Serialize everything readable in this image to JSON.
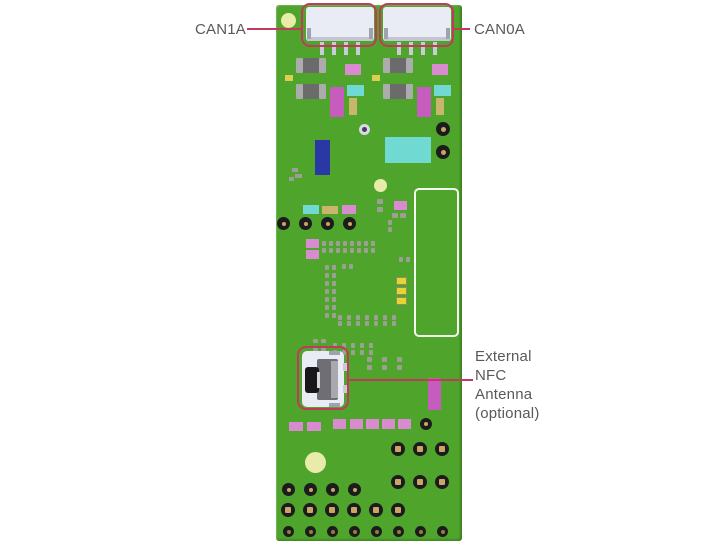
{
  "annotations": {
    "can1a": {
      "text": "CAN1A"
    },
    "can0a": {
      "text": "CAN0A"
    },
    "nfc": {
      "text": "External\nNFC\nAntenna\n(optional)"
    }
  },
  "colors": {
    "green": "#4FA52C",
    "red": "#C23A5B",
    "labelText": "#58595B",
    "connWhite": "#E9EBF5",
    "connShade": "#C3C6D2",
    "pinGray": "#C9CCD6",
    "tabGray": "#9FA3B0",
    "capGray": "#ACACAC",
    "chipDark": "#6B6B6B",
    "orchid": "#D98BD0",
    "magenta": "#C55CBE",
    "cyan": "#6FD9D2",
    "khaki": "#C9B56B",
    "blue": "#2A38A5",
    "paleYellow": "#E9EBA9",
    "padGray": "#9C9F94",
    "yellowPad": "#E6D435",
    "padBorder": "#8F8F5D",
    "holeBlack": "#1C1C1C",
    "holeTan": "#C9A567",
    "holeOlive": "#8F7F40",
    "white": "#F4F7F0",
    "viaWhite": "#DADAE4",
    "viaDot": "#4A3B63",
    "socketDark": "#6E6E74",
    "socketLight": "#A8A8B0",
    "socketBlack": "#17171B",
    "slitWhite": "#D8D8DC",
    "yellowDot": "#DCCE4E"
  },
  "board": {
    "x": 276,
    "y": 5,
    "w": 186,
    "h": 536,
    "items": [
      {
        "t": "c",
        "x": 281,
        "y": 13,
        "d": 15,
        "c": "paleYellow",
        "n": "fiducial-dot"
      },
      {
        "t": "c",
        "x": 374,
        "y": 179,
        "d": 13,
        "c": "paleYellow",
        "n": "fiducial-dot"
      },
      {
        "t": "c",
        "x": 305,
        "y": 452,
        "d": 21,
        "c": "paleYellow",
        "n": "fiducial-dot"
      },
      {
        "t": "r",
        "x": 306,
        "y": 7,
        "w": 68,
        "h": 34,
        "c": "connWhite",
        "r": 3,
        "n": "can1a-connector"
      },
      {
        "t": "r",
        "x": 307,
        "y": 37,
        "w": 66,
        "h": 4,
        "c": "connShade",
        "n": "connector-shadow"
      },
      {
        "t": "r",
        "x": 307,
        "y": 28,
        "w": 4,
        "h": 11,
        "c": "tabGray",
        "n": "connector-tab"
      },
      {
        "t": "r",
        "x": 369,
        "y": 28,
        "w": 4,
        "h": 11,
        "c": "tabGray",
        "n": "connector-tab"
      },
      {
        "t": "r",
        "x": 320,
        "y": 42,
        "w": 4,
        "h": 13,
        "c": "pinGray",
        "n": "connector-pin"
      },
      {
        "t": "r",
        "x": 332,
        "y": 42,
        "w": 4,
        "h": 13,
        "c": "pinGray",
        "n": "connector-pin"
      },
      {
        "t": "r",
        "x": 344,
        "y": 42,
        "w": 4,
        "h": 13,
        "c": "pinGray",
        "n": "connector-pin"
      },
      {
        "t": "r",
        "x": 356,
        "y": 42,
        "w": 4,
        "h": 13,
        "c": "pinGray",
        "n": "connector-pin"
      },
      {
        "t": "r",
        "x": 383,
        "y": 7,
        "w": 68,
        "h": 34,
        "c": "connWhite",
        "r": 3,
        "n": "can0a-connector"
      },
      {
        "t": "r",
        "x": 384,
        "y": 37,
        "w": 66,
        "h": 4,
        "c": "connShade",
        "n": "connector-shadow"
      },
      {
        "t": "r",
        "x": 384,
        "y": 28,
        "w": 4,
        "h": 11,
        "c": "tabGray",
        "n": "connector-tab"
      },
      {
        "t": "r",
        "x": 446,
        "y": 28,
        "w": 4,
        "h": 11,
        "c": "tabGray",
        "n": "connector-tab"
      },
      {
        "t": "r",
        "x": 397,
        "y": 42,
        "w": 4,
        "h": 13,
        "c": "pinGray",
        "n": "connector-pin"
      },
      {
        "t": "r",
        "x": 409,
        "y": 42,
        "w": 4,
        "h": 13,
        "c": "pinGray",
        "n": "connector-pin"
      },
      {
        "t": "r",
        "x": 421,
        "y": 42,
        "w": 4,
        "h": 13,
        "c": "pinGray",
        "n": "connector-pin"
      },
      {
        "t": "r",
        "x": 433,
        "y": 42,
        "w": 4,
        "h": 13,
        "c": "pinGray",
        "n": "connector-pin"
      },
      {
        "t": "chip",
        "x": 296,
        "y": 58,
        "w": 30,
        "h": 15,
        "n": "smd-chip"
      },
      {
        "t": "chip",
        "x": 296,
        "y": 84,
        "w": 30,
        "h": 15,
        "n": "smd-chip"
      },
      {
        "t": "r",
        "x": 285,
        "y": 75,
        "w": 8,
        "h": 6,
        "c": "yellowDot",
        "n": "smd-pad"
      },
      {
        "t": "r",
        "x": 345,
        "y": 64,
        "w": 16,
        "h": 11,
        "c": "orchid",
        "n": "smd-component"
      },
      {
        "t": "r",
        "x": 330,
        "y": 87,
        "w": 14,
        "h": 30,
        "c": "magenta",
        "n": "smd-component"
      },
      {
        "t": "r",
        "x": 347,
        "y": 85,
        "w": 17,
        "h": 11,
        "c": "cyan",
        "n": "smd-component"
      },
      {
        "t": "r",
        "x": 349,
        "y": 98,
        "w": 8,
        "h": 17,
        "c": "khaki",
        "n": "smd-component"
      },
      {
        "t": "chip",
        "x": 383,
        "y": 58,
        "w": 30,
        "h": 15,
        "n": "smd-chip"
      },
      {
        "t": "chip",
        "x": 383,
        "y": 84,
        "w": 30,
        "h": 15,
        "n": "smd-chip"
      },
      {
        "t": "r",
        "x": 372,
        "y": 75,
        "w": 8,
        "h": 6,
        "c": "yellowDot",
        "n": "smd-pad"
      },
      {
        "t": "r",
        "x": 432,
        "y": 64,
        "w": 16,
        "h": 11,
        "c": "orchid",
        "n": "smd-component"
      },
      {
        "t": "r",
        "x": 417,
        "y": 87,
        "w": 14,
        "h": 30,
        "c": "magenta",
        "n": "smd-component"
      },
      {
        "t": "r",
        "x": 434,
        "y": 85,
        "w": 17,
        "h": 11,
        "c": "cyan",
        "n": "smd-component"
      },
      {
        "t": "r",
        "x": 436,
        "y": 98,
        "w": 8,
        "h": 17,
        "c": "khaki",
        "n": "smd-component"
      },
      {
        "t": "c",
        "x": 359,
        "y": 124,
        "d": 11,
        "c": "viaWhite",
        "n": "test-point"
      },
      {
        "t": "c",
        "x": 362,
        "y": 127,
        "d": 5,
        "c": "viaDot",
        "n": "test-point-center"
      },
      {
        "t": "r",
        "x": 315,
        "y": 140,
        "w": 15,
        "h": 35,
        "c": "blue",
        "n": "smd-component"
      },
      {
        "t": "r",
        "x": 385,
        "y": 137,
        "w": 46,
        "h": 26,
        "c": "cyan",
        "n": "smd-component"
      },
      {
        "t": "h",
        "x": 436,
        "y": 122,
        "d": 14,
        "cd": 5,
        "n": "via-hole"
      },
      {
        "t": "h",
        "x": 436,
        "y": 145,
        "d": 14,
        "cd": 5,
        "n": "via-hole"
      },
      {
        "t": "r",
        "x": 292,
        "y": 168,
        "w": 6,
        "h": 4,
        "c": "padGray",
        "n": "smd-pad"
      },
      {
        "t": "r",
        "x": 295,
        "y": 174,
        "w": 7,
        "h": 4,
        "c": "padGray",
        "n": "smd-pad"
      },
      {
        "t": "r",
        "x": 289,
        "y": 177,
        "w": 5,
        "h": 4,
        "c": "padGray",
        "n": "smd-pad"
      },
      {
        "t": "o",
        "x": 414,
        "y": 188,
        "w": 45,
        "h": 149,
        "r": 5,
        "bc": "white",
        "bw": 2,
        "n": "module-outline"
      },
      {
        "t": "r",
        "x": 303,
        "y": 205,
        "w": 16,
        "h": 9,
        "c": "cyan",
        "n": "smd-component"
      },
      {
        "t": "r",
        "x": 322,
        "y": 206,
        "w": 16,
        "h": 8,
        "c": "khaki",
        "n": "smd-component"
      },
      {
        "t": "r",
        "x": 342,
        "y": 205,
        "w": 14,
        "h": 9,
        "c": "orchid",
        "n": "smd-component"
      },
      {
        "t": "grid",
        "x": 377,
        "y": 199,
        "cols": 1,
        "rows": 2,
        "dx": 0,
        "dy": 8,
        "w": 6,
        "h": 5,
        "c": "padGray",
        "n": "pad-array"
      },
      {
        "t": "r",
        "x": 394,
        "y": 201,
        "w": 13,
        "h": 9,
        "c": "orchid",
        "n": "smd-component"
      },
      {
        "t": "grid",
        "x": 392,
        "y": 213,
        "cols": 2,
        "rows": 1,
        "dx": 8,
        "dy": 0,
        "w": 6,
        "h": 5,
        "c": "padGray",
        "n": "pad-array"
      },
      {
        "t": "hrow",
        "x": 277,
        "y": 217,
        "n2": 4,
        "dx": 22,
        "d": 13,
        "cd": 4,
        "n": "via-hole-row"
      },
      {
        "t": "r",
        "x": 306,
        "y": 239,
        "w": 13,
        "h": 9,
        "c": "orchid",
        "n": "smd-component"
      },
      {
        "t": "r",
        "x": 306,
        "y": 250,
        "w": 13,
        "h": 9,
        "c": "orchid",
        "n": "smd-component"
      },
      {
        "t": "grid",
        "x": 322,
        "y": 241,
        "cols": 8,
        "rows": 2,
        "dx": 7,
        "dy": 7,
        "w": 4,
        "h": 5,
        "c": "padGray",
        "n": "pad-array"
      },
      {
        "t": "grid",
        "x": 388,
        "y": 220,
        "cols": 1,
        "rows": 2,
        "dx": 0,
        "dy": 7,
        "w": 4,
        "h": 5,
        "c": "padGray",
        "n": "pad-array"
      },
      {
        "t": "grid",
        "x": 325,
        "y": 265,
        "cols": 2,
        "rows": 7,
        "dx": 7,
        "dy": 8,
        "w": 4,
        "h": 5,
        "c": "padGray",
        "n": "pad-array"
      },
      {
        "t": "grid",
        "x": 342,
        "y": 264,
        "cols": 2,
        "rows": 1,
        "dx": 7,
        "dy": 0,
        "w": 4,
        "h": 5,
        "c": "padGray",
        "n": "pad-array"
      },
      {
        "t": "grid",
        "x": 399,
        "y": 257,
        "cols": 2,
        "rows": 1,
        "dx": 7,
        "dy": 0,
        "w": 4,
        "h": 5,
        "c": "padGray",
        "n": "pad-array"
      },
      {
        "t": "r",
        "x": 396,
        "y": 277,
        "w": 11,
        "h": 8,
        "c": "yellowPad",
        "bd": "padBorder",
        "n": "gold-pad"
      },
      {
        "t": "r",
        "x": 396,
        "y": 287,
        "w": 11,
        "h": 8,
        "c": "yellowPad",
        "bd": "padBorder",
        "n": "gold-pad"
      },
      {
        "t": "r",
        "x": 396,
        "y": 297,
        "w": 11,
        "h": 8,
        "c": "yellowPad",
        "bd": "padBorder",
        "n": "gold-pad"
      },
      {
        "t": "grid",
        "x": 338,
        "y": 315,
        "cols": 7,
        "rows": 2,
        "dx": 9,
        "dy": 6,
        "w": 4,
        "h": 5,
        "c": "padGray",
        "n": "pad-array"
      },
      {
        "t": "grid",
        "x": 313,
        "y": 339,
        "cols": 2,
        "rows": 2,
        "dx": 8,
        "dy": 8,
        "w": 5,
        "h": 4,
        "c": "padGray",
        "n": "pad-array"
      },
      {
        "t": "grid",
        "x": 333,
        "y": 343,
        "cols": 5,
        "rows": 2,
        "dx": 9,
        "dy": 7,
        "w": 4,
        "h": 5,
        "c": "padGray",
        "n": "pad-array"
      },
      {
        "t": "grid",
        "x": 367,
        "y": 357,
        "cols": 3,
        "rows": 2,
        "dx": 15,
        "dy": 8,
        "w": 5,
        "h": 5,
        "c": "padGray",
        "n": "pad-array"
      },
      {
        "t": "r",
        "x": 302,
        "y": 351,
        "w": 42,
        "h": 56,
        "c": "connWhite",
        "r": 5,
        "n": "nfc-connector-body"
      },
      {
        "t": "r",
        "x": 317,
        "y": 359,
        "w": 21,
        "h": 41,
        "c": "socketDark",
        "r": 2,
        "n": "nfc-socket"
      },
      {
        "t": "r",
        "x": 331,
        "y": 361,
        "w": 7,
        "h": 37,
        "c": "socketLight",
        "n": "nfc-socket-highlight"
      },
      {
        "t": "r",
        "x": 305,
        "y": 367,
        "w": 14,
        "h": 26,
        "c": "socketBlack",
        "r": 3,
        "n": "nfc-socket-port"
      },
      {
        "t": "r",
        "x": 317,
        "y": 372,
        "w": 3,
        "h": 16,
        "c": "slitWhite",
        "n": "nfc-socket-slit"
      },
      {
        "t": "r",
        "x": 329,
        "y": 351,
        "w": 11,
        "h": 4,
        "c": "tabGray",
        "n": "connector-tab"
      },
      {
        "t": "r",
        "x": 329,
        "y": 403,
        "w": 11,
        "h": 4,
        "c": "tabGray",
        "n": "connector-tab"
      },
      {
        "t": "r",
        "x": 343,
        "y": 363,
        "w": 5,
        "h": 8,
        "c": "pinGray",
        "n": "connector-tab"
      },
      {
        "t": "r",
        "x": 343,
        "y": 385,
        "w": 5,
        "h": 8,
        "c": "pinGray",
        "n": "connector-tab"
      },
      {
        "t": "r",
        "x": 428,
        "y": 378,
        "w": 13,
        "h": 32,
        "c": "magenta",
        "n": "smd-component"
      },
      {
        "t": "r",
        "x": 289,
        "y": 422,
        "w": 14,
        "h": 9,
        "c": "orchid",
        "n": "smd-pad"
      },
      {
        "t": "r",
        "x": 307,
        "y": 422,
        "w": 14,
        "h": 9,
        "c": "orchid",
        "n": "smd-pad"
      },
      {
        "t": "r",
        "x": 333,
        "y": 419,
        "w": 13,
        "h": 10,
        "c": "orchid",
        "n": "smd-pad"
      },
      {
        "t": "r",
        "x": 350,
        "y": 419,
        "w": 13,
        "h": 10,
        "c": "orchid",
        "n": "smd-pad"
      },
      {
        "t": "r",
        "x": 366,
        "y": 419,
        "w": 13,
        "h": 10,
        "c": "orchid",
        "n": "smd-pad"
      },
      {
        "t": "r",
        "x": 382,
        "y": 419,
        "w": 13,
        "h": 10,
        "c": "orchid",
        "n": "smd-pad"
      },
      {
        "t": "r",
        "x": 398,
        "y": 419,
        "w": 13,
        "h": 10,
        "c": "orchid",
        "n": "smd-pad"
      },
      {
        "t": "h",
        "x": 420,
        "y": 418,
        "d": 12,
        "cd": 4,
        "n": "via-hole"
      },
      {
        "t": "hrow",
        "x": 391,
        "y": 442,
        "n2": 3,
        "dx": 22,
        "d": 14,
        "cd": 6,
        "sq": true,
        "n": "through-hole-row"
      },
      {
        "t": "hrow",
        "x": 391,
        "y": 475,
        "n2": 3,
        "dx": 22,
        "d": 14,
        "cd": 6,
        "sq": true,
        "n": "through-hole-row"
      },
      {
        "t": "hrow",
        "x": 282,
        "y": 483,
        "n2": 4,
        "dx": 22,
        "d": 13,
        "cd": 4,
        "n": "via-hole-row"
      },
      {
        "t": "hrow",
        "x": 281,
        "y": 503,
        "n2": 6,
        "dx": 22,
        "d": 14,
        "cd": 6,
        "sq": true,
        "n": "through-hole-row"
      },
      {
        "t": "hrow",
        "x": 283,
        "y": 526,
        "n2": 8,
        "dx": 22,
        "d": 11,
        "cd": 4,
        "core": "holeOlive",
        "n": "via-hole-row"
      },
      {
        "t": "o",
        "x": 301,
        "y": 3,
        "w": 76,
        "h": 44,
        "r": 9,
        "bc": "red",
        "bw": 2,
        "n": "can1a-highlight"
      },
      {
        "t": "o",
        "x": 379,
        "y": 3,
        "w": 75,
        "h": 44,
        "r": 9,
        "bc": "red",
        "bw": 2,
        "n": "can0a-highlight"
      },
      {
        "t": "o",
        "x": 297,
        "y": 346,
        "w": 52,
        "h": 64,
        "r": 9,
        "bc": "red",
        "bw": 2,
        "n": "nfc-highlight"
      },
      {
        "t": "r",
        "x": 247,
        "y": 28,
        "w": 54,
        "h": 2,
        "c": "red",
        "n": "can1a-callout-line"
      },
      {
        "t": "r",
        "x": 454,
        "y": 28,
        "w": 16,
        "h": 2,
        "c": "red",
        "n": "can0a-callout-line"
      },
      {
        "t": "r",
        "x": 349,
        "y": 379,
        "w": 124,
        "h": 2,
        "c": "red",
        "n": "nfc-callout-line"
      }
    ]
  }
}
